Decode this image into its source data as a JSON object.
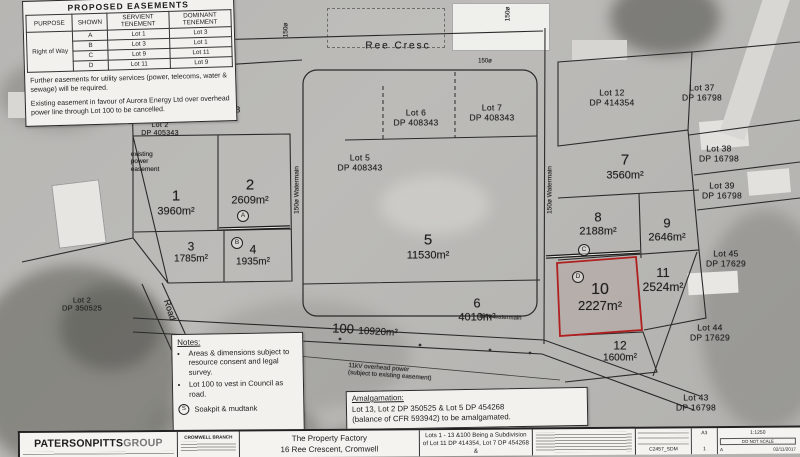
{
  "plan": {
    "colors": {
      "highlight": "#b02020",
      "paper": "#f2f1ed",
      "ink": "#1c1c1c"
    },
    "easement_table": {
      "title": "PROPOSED EASEMENTS",
      "col_purpose": "PURPOSE",
      "col_shown": "SHOWN",
      "col_servient": "SERVIENT TENEMENT",
      "col_dominant": "DOMINANT TENEMENT",
      "purpose": "Right of Way",
      "rows": [
        {
          "shown": "A",
          "servient": "Lot 1",
          "dominant": "Lot 3"
        },
        {
          "shown": "B",
          "servient": "Lot 3",
          "dominant": "Lot 1"
        },
        {
          "shown": "C",
          "servient": "Lot 9",
          "dominant": "Lot 11"
        },
        {
          "shown": "D",
          "servient": "Lot 11",
          "dominant": "Lot 9"
        }
      ],
      "note_utilities": "Further easements for utility services (power, telecoms, water & sewage) will be required.",
      "note_existing": "Existing easement in favour of Aurora Energy Ltd over overhead power line through Lot 100 to be cancelled."
    },
    "lots": {
      "lot1": {
        "number": "1",
        "area": "3960m²"
      },
      "lot2": {
        "number": "2",
        "area": "2609m²"
      },
      "lot3": {
        "number": "3",
        "area": "1785m²"
      },
      "lot4": {
        "number": "4",
        "area": "1935m²"
      },
      "lot5": {
        "number": "5",
        "area": "11530m²"
      },
      "lot6": {
        "number": "6",
        "area": "4010m²"
      },
      "lot7": {
        "number": "7",
        "area": "3560m²"
      },
      "lot8": {
        "number": "8",
        "area": "2188m²"
      },
      "lot9": {
        "number": "9",
        "area": "2646m²"
      },
      "lot10": {
        "number": "10",
        "area": "2227m²"
      },
      "lot11": {
        "number": "11",
        "area": "2524m²"
      },
      "lot12": {
        "number": "12",
        "area": "1600m²"
      },
      "lot13": {
        "number": "13",
        "area": "27.07 Ha",
        "balance": "Balance",
        "ref": "Lot 3",
        "dp": "DP 350525"
      },
      "lot100": {
        "number": "100",
        "area": "10920m²"
      }
    },
    "adjoining": {
      "lot4_dp408343": {
        "l1": "Lot 4",
        "l2": "DP 408343"
      },
      "lot5_dp408343": {
        "l1": "Lot 5",
        "l2": "DP 408343"
      },
      "lot6_dp408343": {
        "l1": "Lot 6",
        "l2": "DP 408343"
      },
      "lot7_dp408343": {
        "l1": "Lot 7",
        "l2": "DP 408343"
      },
      "lot12_dp414354": {
        "l1": "Lot 12",
        "l2": "DP 414354"
      },
      "lot2_dp405343": {
        "l1": "Lot 2",
        "l2": "DP 405343"
      },
      "lot2_dp350525": {
        "l1": "Lot 2",
        "l2": "DP 350525"
      },
      "lot37": {
        "l1": "Lot 37",
        "l2": "DP 16798"
      },
      "lot38": {
        "l1": "Lot 38",
        "l2": "DP 16798"
      },
      "lot39": {
        "l1": "Lot 39",
        "l2": "DP 16798"
      },
      "lot45": {
        "l1": "Lot 45",
        "l2": "DP 17629"
      },
      "lot44": {
        "l1": "Lot 44",
        "l2": "DP 17629"
      },
      "lot43": {
        "l1": "Lot 43",
        "l2": "DP 16798"
      }
    },
    "streets": {
      "ree_cresc": "Ree Cresc",
      "road": "Road"
    },
    "annotations": {
      "existing_power_1": "existing",
      "existing_power_2": "power",
      "existing_power_3": "easement",
      "watermain_left": "150ø Watermain",
      "watermain_right": "150ø Watermain",
      "watermain_road": "150ø watermain",
      "dim_150_a": "150ø",
      "dim_150_b": "150ø",
      "dim_150_c": "150ø",
      "power_line_1": "11kV overhead power",
      "power_line_2": "(subject to existing easement)",
      "mark_a": "A",
      "mark_b": "B",
      "mark_c": "C",
      "mark_d": "D"
    },
    "notes_box": {
      "title": "Notes:",
      "bullet1": "Areas & dimensions subject to resource consent and legal survey.",
      "bullet2": "Lot 100 to vest in Council as road.",
      "soak_symbol": "S",
      "soak_text": "Soakpit & mudtank"
    },
    "amalgamation": {
      "title": "Amalgamation:",
      "line1": "Lot 13, Lot 2 DP 350525 & Lot 5 DP 454268",
      "line2": "(balance of CFR 593942) to be amalgamated."
    },
    "titleblock": {
      "firm_main": "PATERSONPITTS",
      "firm_sub": "GROUP",
      "branch": "CROMWELL BRANCH",
      "client1": "The Property Factory",
      "client2": "16 Ree Crescent, Cromwell",
      "title1": "Lots 1 - 13 &100 Being a Subdivision",
      "title2": "of Lot 11 DP 414354, Lot 7 DP 454268 &",
      "title3": "Lot 2 DP 350525",
      "sheet_size": "A3",
      "scale": "1:1250",
      "do_not_scale": "DO NOT SCALE",
      "drawing_no": "C2457_SDM",
      "sheet": "1",
      "rev": "A",
      "date": "02/11/2017"
    }
  }
}
